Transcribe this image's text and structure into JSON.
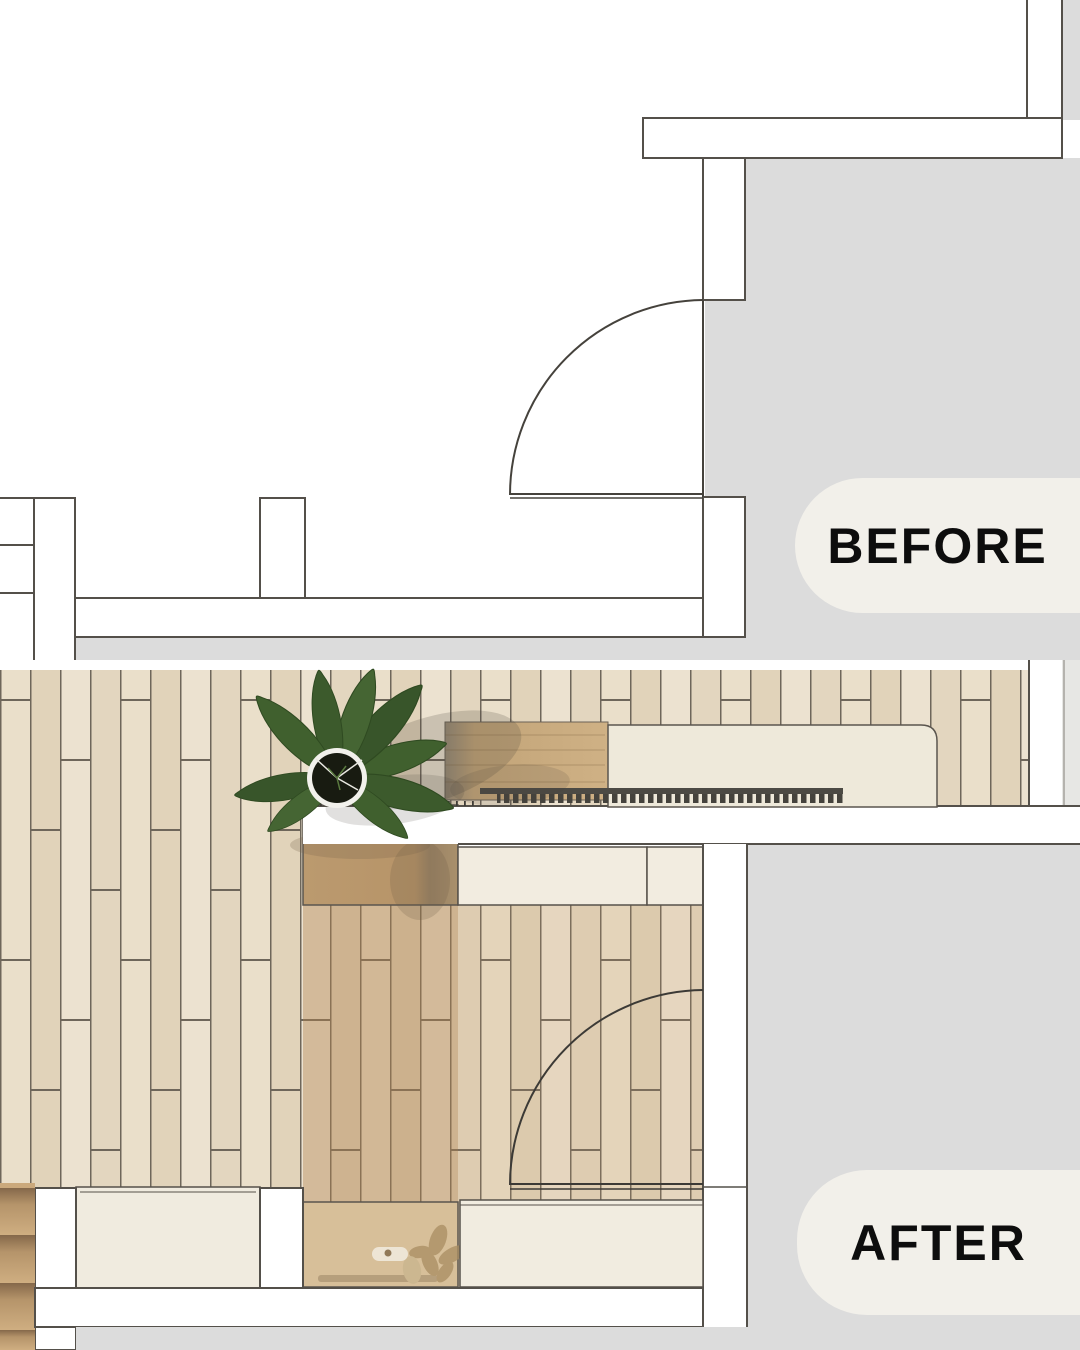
{
  "page": {
    "title": "Floor plan renovation comparison graphic",
    "width_px": 1080,
    "height_px": 1350
  },
  "labels": {
    "before": "BEFORE",
    "after": "AFTER"
  },
  "colors": {
    "background": "#ffffff",
    "neutral_gray": "#dcdcdc",
    "corner_light_gray": "#e7e7e4",
    "pill_background": "#f2f0ea",
    "pill_text": "#0d0d0d",
    "wall_outline": "#54504a",
    "wall_fill": "#ffffff",
    "door_line": "#45423c",
    "floor_plank_light": "#e7dcc7",
    "floor_joint": "#6e665a",
    "wood_countertop": "#c7a87c",
    "wood_wardrobe": "#bb9a6f",
    "wood_wardrobe_base": "#d7bf99",
    "cream_surface": "#eee9da",
    "cream_cabinet": "#f2ece0",
    "plant_leaf_green": "#40602e",
    "plant_pot_black": "#181b11",
    "grille_dark": "#45433d",
    "step_wood": "#b5946a"
  },
  "objects": {
    "before_plan": [
      "entry-door-swing",
      "top-wall",
      "side-wall",
      "bottom-wall",
      "column",
      "stair-steps",
      "adjacent-room-area"
    ],
    "after_plan": [
      "wood-plank-floor",
      "potted-plant",
      "wood-countertop",
      "desk-surface",
      "radiator-grille",
      "tall-wardrobe",
      "built-in-cabinets",
      "storage-bench",
      "niche-cabinet",
      "entry-door-swing",
      "stair-steps",
      "adjacent-room-area"
    ]
  }
}
